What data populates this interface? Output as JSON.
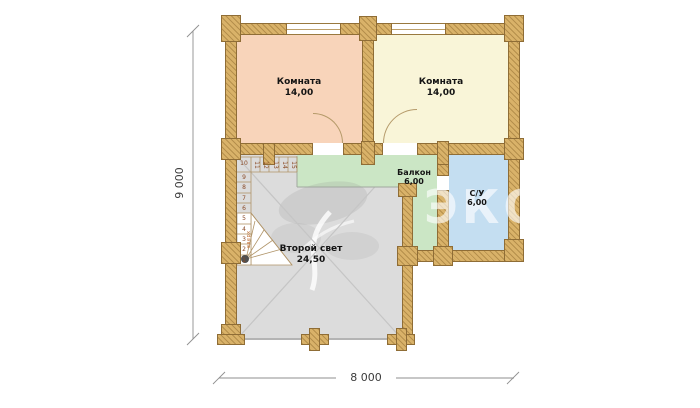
{
  "watermark": {
    "text": "ЭКО-ТЕХ"
  },
  "plan": {
    "wall_color": "#d9b269",
    "rooms": [
      {
        "key": "room-left",
        "label": "Комната",
        "area": "14,00",
        "color": "#f8d4ba"
      },
      {
        "key": "room-right",
        "label": "Комната",
        "area": "14,00",
        "color": "#f9f5d8"
      },
      {
        "key": "balcony",
        "label": "Балкон",
        "area": "6,00",
        "color": "#cbe6c5"
      },
      {
        "key": "bathroom",
        "label": "С/У",
        "area": "6,00",
        "color": "#c4def1"
      },
      {
        "key": "void",
        "label": "Второй свет",
        "area": "24,50",
        "color": "#dcdcdc"
      }
    ],
    "stairs": {
      "direction_label": "вверх",
      "corner_step": "10",
      "run_steps": [
        "11",
        "12",
        "13",
        "14",
        "15"
      ],
      "column_steps": [
        "9",
        "8",
        "7",
        "6",
        "5",
        "4",
        "3",
        "2",
        "1"
      ]
    },
    "dimensions": {
      "vertical": "9 000",
      "horizontal": "8 000"
    }
  }
}
